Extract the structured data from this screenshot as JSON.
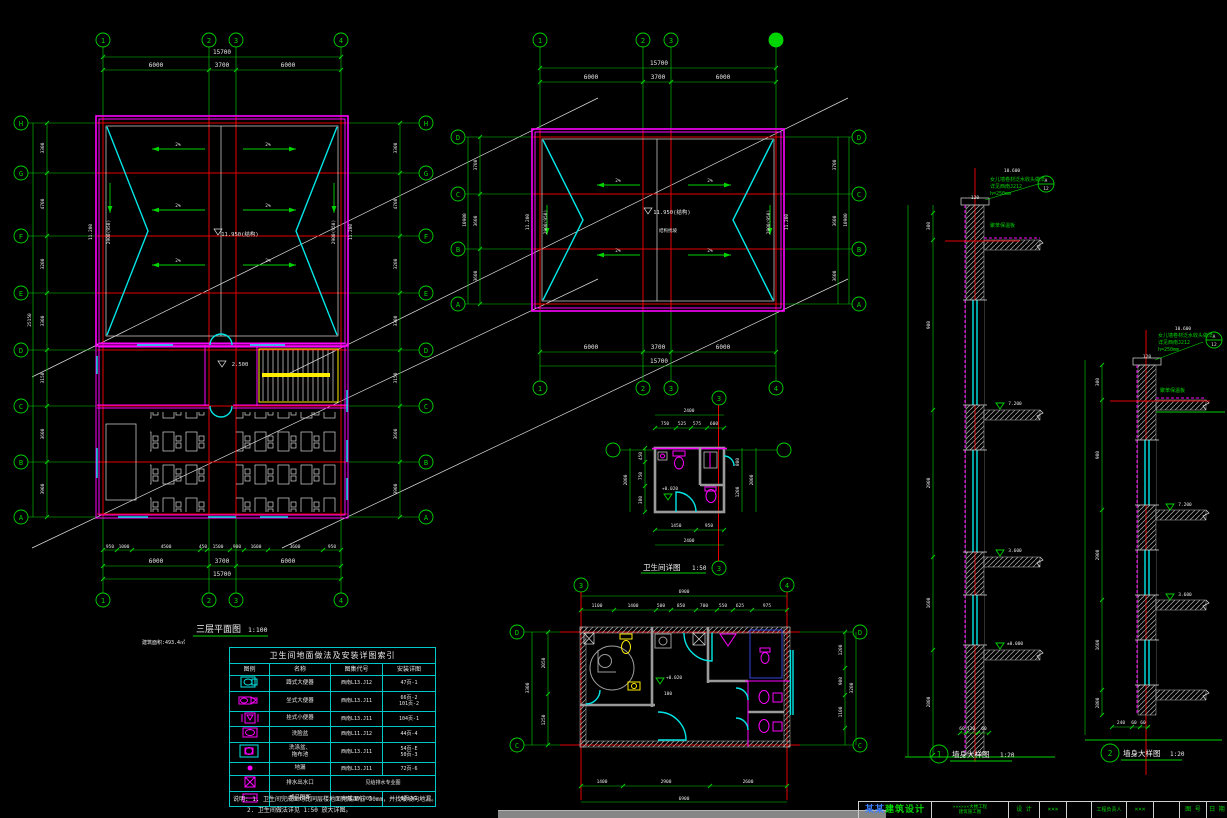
{
  "left_plan": {
    "title": "三层平面图",
    "scale": "1:100",
    "note": "建筑面积:493.4㎡",
    "grid_cols": [
      "1",
      "2",
      "3",
      "4"
    ],
    "grid_rows": [
      "H",
      "G",
      "F",
      "E",
      "D",
      "C",
      "B",
      "A"
    ],
    "dim_total": "15700",
    "dim_segs": [
      "6000",
      "3700",
      "6000"
    ],
    "dim_bottom_detail": [
      "950",
      "1000",
      "4500",
      "450",
      "1500",
      "900",
      "1600",
      "3600",
      "950"
    ],
    "dim_rows": [
      "3300",
      "4700",
      "3200",
      "3300",
      "3150",
      "3600",
      "3900"
    ],
    "dim_rows_total": "25150",
    "slope": "2%",
    "ridge_level": "11.950(结构)",
    "eave_level": "11.200",
    "parapet_dim": "2900(950)",
    "stair_level": "2.500"
  },
  "mid_plan": {
    "grid_cols": [
      "1",
      "2",
      "3",
      "4"
    ],
    "grid_rows": [
      "D",
      "C",
      "B",
      "A"
    ],
    "dim_total": "15700",
    "dim_segs": [
      "6000",
      "3700",
      "6000"
    ],
    "dim_rows": [
      "3700",
      "3600",
      "3600"
    ],
    "dim_rows_total": "10900",
    "slope": "2%",
    "ridge_level": "11.950(结构)",
    "ridge_note": "结构找坡",
    "eave_level": "11.200",
    "parapet_dim": "2900(950)"
  },
  "small_detail": {
    "title": "卫生间详图",
    "scale": "1:50",
    "grid_ref": "3",
    "dim_top_total": "2400",
    "dim_top": [
      "750",
      "525",
      "575",
      "600"
    ],
    "dim_bottom": [
      "1450",
      "950"
    ],
    "dim_bottom_total": "2400",
    "dim_left": [
      "450",
      "750",
      "380"
    ],
    "dim_left_total": "2000",
    "dim_right": [
      "800",
      "1200"
    ],
    "dim_right_total": "2000",
    "level": "+0.020"
  },
  "big_detail": {
    "grid_cols": [
      "3",
      "4"
    ],
    "grid_rows": [
      "D",
      "C"
    ],
    "dim_top_total": "6900",
    "dim_top": [
      "1100",
      "1400",
      "500",
      "850",
      "700",
      "550",
      "625",
      "975"
    ],
    "dim_bottom": [
      "1400",
      "2900",
      "2600"
    ],
    "dim_bottom_total": "6900",
    "dim_left": [
      "2050",
      "1250"
    ],
    "dim_left_total": "3300",
    "dim_right": [
      "1200",
      "900",
      "1100"
    ],
    "dim_right_total": "3200",
    "level": "+0.020",
    "room_note": "100"
  },
  "sections": [
    {
      "no": "1",
      "title": "墙身大样图",
      "scale": "1:20",
      "top_level": "10.600",
      "notes": [
        "女儿墙卷材泛水收头做法",
        "详见西南J212",
        "h=250mm"
      ],
      "insulation": "聚苯保温板",
      "levels": [
        "7.200",
        "3.600",
        "±0.000"
      ],
      "dim_top": [
        "50",
        "120",
        "90"
      ],
      "dim_bottom": [
        "60",
        "120",
        "60"
      ],
      "dim_left": [
        "300",
        "900",
        "2900",
        "1600",
        "2800"
      ],
      "ref_no": "A",
      "ref_sheet": "12"
    },
    {
      "no": "2",
      "title": "墙身大样图",
      "scale": "1:20",
      "top_level": "10.600",
      "notes": [
        "女儿墙卷材泛水收头做法",
        "详见西南J212",
        "h=250mm"
      ],
      "insulation": "聚苯保温板",
      "levels": [
        "7.200",
        "3.600"
      ],
      "dim_top": [
        "50",
        "120",
        "60"
      ],
      "dim_bottom": [
        "240",
        "60",
        "60"
      ],
      "dim_left": [
        "300",
        "900",
        "2900",
        "1600",
        "2800"
      ],
      "ref_no": "A",
      "ref_sheet": "12"
    }
  ],
  "legend": {
    "title": "卫生间地面做法及安装详图索引",
    "headers": [
      "图例",
      "名称",
      "图集代号",
      "安装详图"
    ],
    "rows": [
      {
        "name": "蹲式大便器",
        "name2": "",
        "code": "西南L13.J12",
        "p1": "47页-1",
        "p2": ""
      },
      {
        "name": "坐式大便器",
        "name2": "",
        "code": "西南L13.J11",
        "p1": "66页-2",
        "p2": "101页-2"
      },
      {
        "name": "挂式小便器",
        "name2": "",
        "code": "西南L13.J11",
        "p1": "104页-1",
        "p2": ""
      },
      {
        "name": "洗脸盆",
        "name2": "",
        "code": "西南L11.J12",
        "p1": "44页-4",
        "p2": ""
      },
      {
        "name": "洗涤盆、",
        "name2": "拖布池",
        "code": "西南L13.J11",
        "p1": "54页-E",
        "p2": "50页-3"
      },
      {
        "name": "地漏",
        "name2": "",
        "code": "西南L13.J11",
        "p1": "72页-6",
        "p2": ""
      },
      {
        "name": "排水出水口",
        "name2": "",
        "code": "见给排水专业图",
        "p1": "",
        "p2": ""
      },
      {
        "name": "成品隔断",
        "name2": "",
        "code": "西南L10.J05",
        "p1": "6页-W1",
        "p2": ""
      }
    ],
    "note1": "说明: 1. 卫生间完成面均比同层楼地面完成面低 30mm，并找坡坡向地漏。",
    "note2": "2. 卫生间做法详见 1:50 放大详图。"
  },
  "titleblock": {
    "logo_prefix": "某某",
    "logo_suffix": "建筑设计",
    "project_line1": "××××××大楼工程",
    "project_line2": "建筑施工图",
    "cells": [
      "设 计",
      "×××",
      "",
      "工程负责人",
      "×××",
      "",
      "图 号",
      "日 期"
    ]
  }
}
